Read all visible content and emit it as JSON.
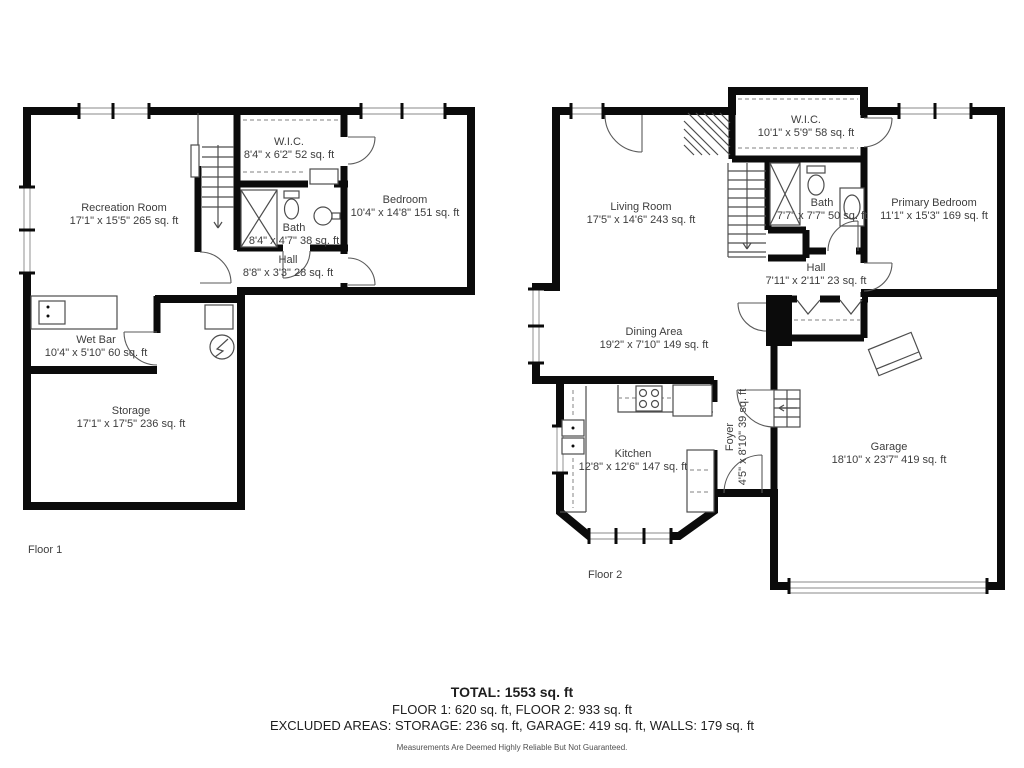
{
  "document_type": "floor-plan",
  "colors": {
    "walls": "#0b0b0b",
    "lines": "#4d4d4d",
    "label_text": "#3d3d3d",
    "window_lines": "#b0b0b0"
  },
  "floor1": {
    "label": "Floor 1",
    "rooms": [
      {
        "id": "recreation-room",
        "name": "Recreation Room",
        "dims": "17'1\" x 15'5\" 265 sq. ft"
      },
      {
        "id": "wic",
        "name": "W.I.C.",
        "dims": "8'4\" x 6'2\" 52 sq. ft"
      },
      {
        "id": "bedroom",
        "name": "Bedroom",
        "dims": "10'4\" x 14'8\" 151 sq. ft"
      },
      {
        "id": "bath",
        "name": "Bath",
        "dims": "8'4\" x 4'7\" 38 sq. ft"
      },
      {
        "id": "hall",
        "name": "Hall",
        "dims": "8'8\" x 3'3\" 28 sq. ft"
      },
      {
        "id": "wet-bar",
        "name": "Wet Bar",
        "dims": "10'4\" x 5'10\" 60 sq. ft"
      },
      {
        "id": "storage",
        "name": "Storage",
        "dims": "17'1\" x 17'5\" 236 sq. ft"
      }
    ]
  },
  "floor2": {
    "label": "Floor 2",
    "rooms": [
      {
        "id": "living-room",
        "name": "Living Room",
        "dims": "17'5\" x 14'6\" 243 sq. ft"
      },
      {
        "id": "wic",
        "name": "W.I.C.",
        "dims": "10'1\" x 5'9\" 58 sq. ft"
      },
      {
        "id": "bath",
        "name": "Bath",
        "dims": "7'7\" x 7'7\" 50 sq. ft"
      },
      {
        "id": "primary-bedroom",
        "name": "Primary Bedroom",
        "dims": "11'1\" x 15'3\" 169 sq. ft"
      },
      {
        "id": "hall",
        "name": "Hall",
        "dims": "7'11\" x 2'11\" 23 sq. ft"
      },
      {
        "id": "dining-area",
        "name": "Dining Area",
        "dims": "19'2\" x 7'10\" 149 sq. ft"
      },
      {
        "id": "kitchen",
        "name": "Kitchen",
        "dims": "12'8\" x 12'6\" 147 sq. ft"
      },
      {
        "id": "foyer",
        "name": "Foyer",
        "dims": "4'5\" x 8'10\" 39 sq. ft",
        "orientation": "vertical"
      },
      {
        "id": "garage",
        "name": "Garage",
        "dims": "18'10\" x 23'7\" 419 sq. ft"
      }
    ]
  },
  "summary": {
    "total": "TOTAL: 1553 sq. ft",
    "floors": "FLOOR 1: 620 sq. ft, FLOOR 2: 933 sq. ft",
    "excluded": "EXCLUDED AREAS: STORAGE: 236 sq. ft, GARAGE: 419 sq. ft, WALLS: 179 sq. ft",
    "disclaimer": "Measurements Are Deemed Highly Reliable But Not Guaranteed."
  }
}
